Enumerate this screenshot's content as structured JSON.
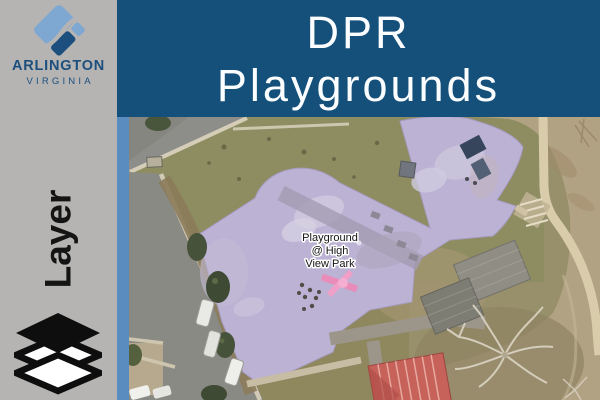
{
  "header": {
    "logo": {
      "name": "ARLINGTON",
      "subname": "VIRGINIA"
    },
    "title": {
      "line1": "DPR",
      "line2": "Playgrounds"
    }
  },
  "sidebar": {
    "layer_label": "Layer"
  },
  "map": {
    "feature_label": {
      "line1": "Playground",
      "line2": "@ High",
      "line3": "View Park"
    },
    "basemap": "aerial-imagery",
    "highlighted_feature": "playground-outline"
  },
  "icons": {
    "logo_icon": "arlington-county-diamond",
    "layers_icon": "layers-stack"
  },
  "colors": {
    "header_bg": "#15507B",
    "panel_gray": "#B5B4B2",
    "map_border_blue": "#5A8CC0",
    "logo_navy": "#1D4F7E",
    "logo_light_blue": "#7EA7D2",
    "playground_highlight": "#BBB2D4",
    "title_text": "#FBFDFE",
    "layer_text": "#141414"
  }
}
